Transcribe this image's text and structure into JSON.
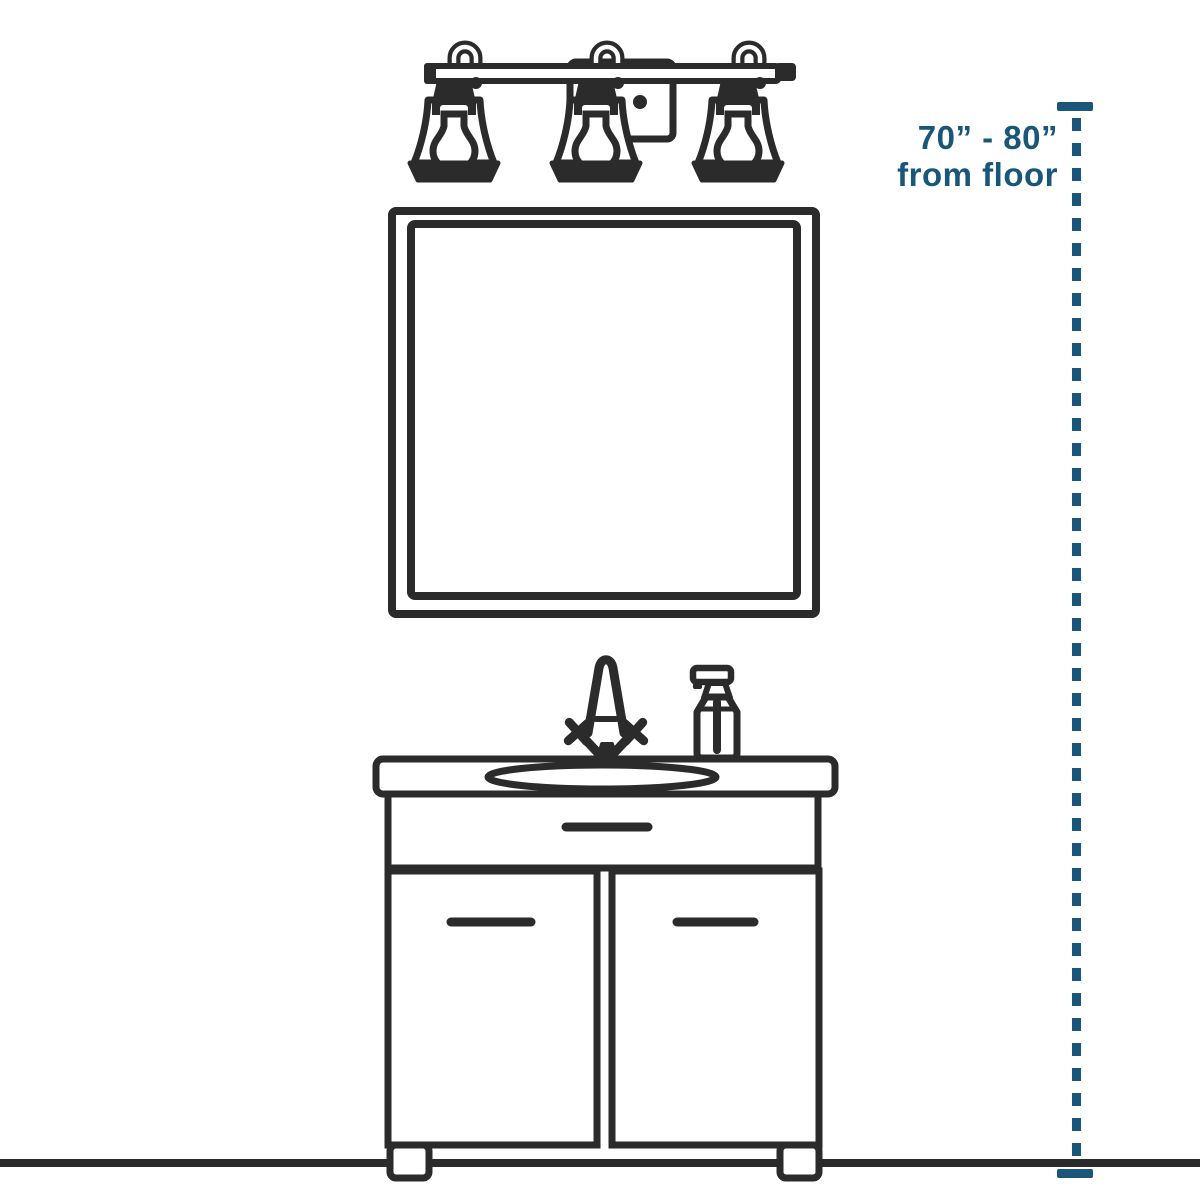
{
  "annotation": {
    "line1": "70” - 80”",
    "line2": "from floor"
  },
  "colors": {
    "ink": "#2b2b2b",
    "accent": "#195679",
    "background": "#ffffff"
  }
}
